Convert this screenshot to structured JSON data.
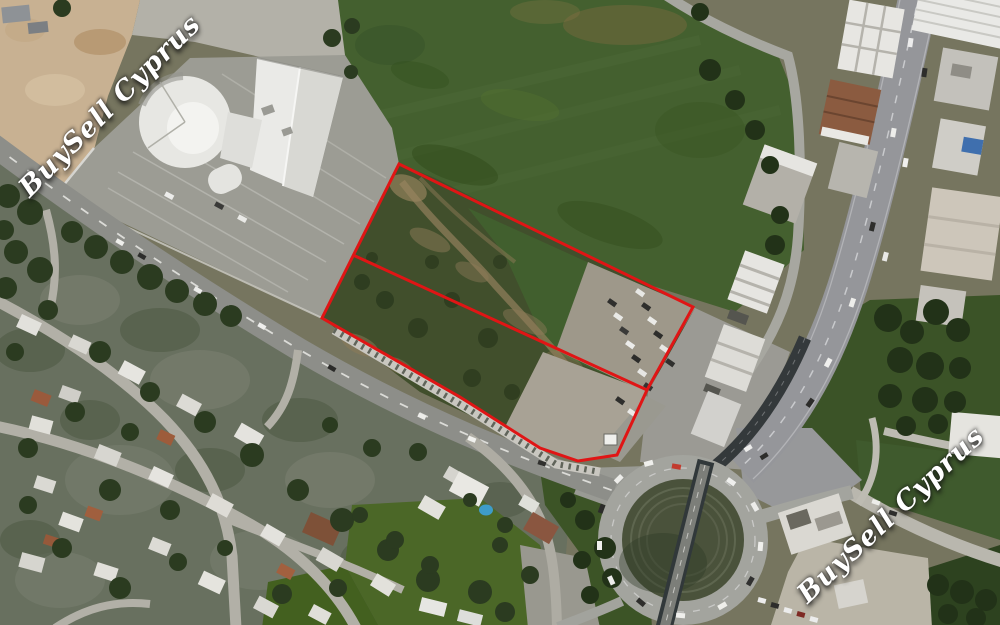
{
  "watermarks": {
    "left": {
      "text": "BuySell Cyprus"
    },
    "right": {
      "text": "BuySell Cyprus"
    }
  },
  "plot_overlay": {
    "color": "#e01515",
    "stroke_width": "3",
    "outer_boundary_points": "399,164 693,307 647,390 617,455 578,461 540,448 460,397 322,318",
    "divider_points": "353,255 647,390"
  },
  "palette": {
    "field_green": "#44602f",
    "scrub_green": "#414f2c",
    "dirt_tan": "#c8b192",
    "road_gray": "#8d8e89",
    "watermark_color": "#ffffff"
  }
}
